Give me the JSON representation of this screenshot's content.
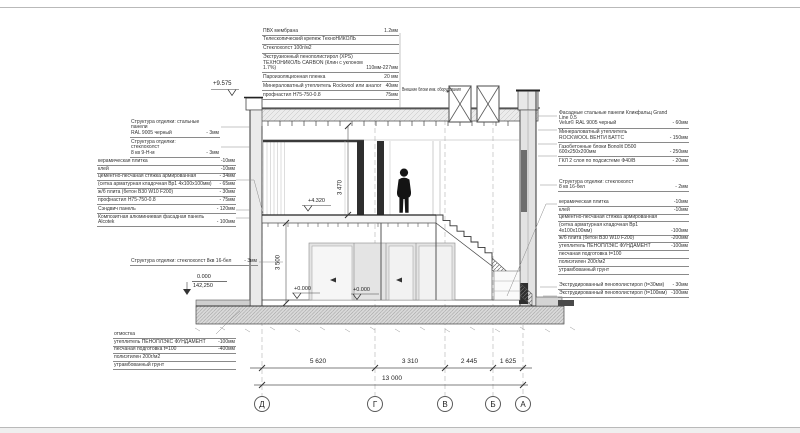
{
  "colors": {
    "line": "#3a3a3a",
    "light": "#b9b9b9",
    "fill": "#e7e7e7",
    "dark": "#1a1a1a",
    "hatch": "#9a9a9a"
  },
  "axes": [
    "Д",
    "Г",
    "В",
    "Б",
    "А"
  ],
  "dimensions": {
    "segments": [
      "5 620",
      "3 310",
      "2 445",
      "1 625"
    ],
    "total": "13 000",
    "height_upper": "3 470",
    "height_ground": "3 500"
  },
  "elevations": {
    "roof": "+9.575",
    "second_floor": "+4.320",
    "ground_floor": "+0.000",
    "ground_floor_b": "+0.000",
    "datum": "0.000",
    "datum_abs": "142,250"
  },
  "callouts": {
    "roof": {
      "rows": [
        {
          "t": "ПВХ мембрана",
          "v": "1.2мм"
        },
        {
          "t": "Телескопический крепеж ТехноНИКОЛЬ",
          "v": ""
        },
        {
          "t": "Стеклохолст 100г/м2",
          "v": ""
        },
        {
          "t": "Экструзионный пенополистирол (XPS)",
          "t2": "ТЕХНОНИКОЛЬ CARBON (Клин с уклоном 1.7%)",
          "v": "110мм-227мм"
        },
        {
          "t": "Пароизоляционная пленка",
          "v": "20 мм"
        },
        {
          "t": "Минераловатный утеплитель Rockwool или аналог",
          "v": "40мм"
        },
        {
          "t": "профнастил Н75-750-0.8",
          "v": "75мм"
        }
      ]
    },
    "equipment": {
      "label": "Внешние блоки инж. оборудования"
    },
    "wall_finish_upper": {
      "rows": [
        {
          "t": "Структура отделки: стальные панели",
          "t2": "RAL 9005 черный",
          "v": "- 3мм"
        }
      ]
    },
    "ceiling_finish_upper": {
      "rows": [
        {
          "t": "Структура отделки: стеклохолст",
          "t2": "8 кв 9-Н-м",
          "v": "- 3мм"
        }
      ]
    },
    "floor_upper": {
      "rows": [
        {
          "t": "керамическая плитка",
          "v": "-10мм"
        },
        {
          "t": "клей",
          "v": "-10мм"
        },
        {
          "t": "цементно-песчаная стяжка армированная",
          "v": "- 34мм"
        },
        {
          "t": "(сетка арматурная кладочная Вр1 4х100х100мм)",
          "v": "- 65мм"
        },
        {
          "t": "ж/б плита (бетон B30 W10 F200)",
          "v": "- 30мм"
        },
        {
          "t": "профнастил Н75-750-0.8",
          "v": "- 75мм"
        }
      ]
    },
    "sandwich": {
      "rows": [
        {
          "t": "Сэндвич панель",
          "v": "- 120мм"
        }
      ]
    },
    "composite": {
      "rows": [
        {
          "t": "Композитная алюминиевая фасадная панель Alcotek",
          "v": "- 100мм"
        }
      ]
    },
    "interior_finish_ground": {
      "rows": [
        {
          "t": "Структура отделки: стеклохолст 8кв 16-бел",
          "v": "- 3мм"
        }
      ]
    },
    "blind_area": {
      "rows": [
        {
          "t": "отмостка",
          "v": ""
        },
        {
          "t": "утеплитель ПЕНОПЛЭКС ФУНДАМЕНТ",
          "v": "-100мм"
        },
        {
          "t": "песчаная подготовка t=100",
          "v": "-400мм"
        },
        {
          "t": "полиэтилен 200г/м2",
          "v": ""
        },
        {
          "t": "утрамбованный грунт",
          "v": ""
        }
      ]
    },
    "facade_right": {
      "rows": [
        {
          "t": "Фасадные стальные панели Кликфальц Grand Line 0.5",
          "t2": "Velur© RAL 9005 черный",
          "v": "- 60мм"
        },
        {
          "t": "Минераловатный утеплитель",
          "t2": "ROCKWOOL ВЕНТИ БАТТС",
          "v": "- 150мм"
        },
        {
          "t": "Газобетонные блоки Bonolit D500 600х250х200мм",
          "v": "- 250мм"
        },
        {
          "t": "ГКЛ 2 слоя по подсистеме Ф40/В",
          "v": "- 20мм"
        }
      ]
    },
    "interior_finish_right": {
      "rows": [
        {
          "t": "Структура отделки: стеклохолст",
          "t2": "8 кв 16-бел",
          "v": "- 2мм"
        }
      ]
    },
    "floor_ground": {
      "rows": [
        {
          "t": "керамическая плитка",
          "v": "-10мм"
        },
        {
          "t": "клей",
          "v": "-10мм"
        },
        {
          "t": "цементно-песчаная стяжка армированная",
          "v": ""
        },
        {
          "t": "(сетка арматурная кладочная Вр1 4х100х100мм)",
          "v": "-100мм"
        },
        {
          "t": "ж/б плита (бетон B30 W10 F200)",
          "v": "-200мм"
        },
        {
          "t": "утеплитель ПЕНОПЛЭКС ФУНДАМЕНТ",
          "v": "-100мм"
        },
        {
          "t": "песчаная подготовка t=100",
          "v": ""
        },
        {
          "t": "полиэтилен 200г/м2",
          "v": ""
        },
        {
          "t": "утрамбованный грунт",
          "v": ""
        }
      ]
    },
    "xps": {
      "rows": [
        {
          "t": "Экструдированный пенополистирол (t=30мм)",
          "v": "- 30мм"
        },
        {
          "t": "Экструдированный пенополистирол (t=100мм)",
          "v": "-100мм"
        }
      ]
    }
  }
}
